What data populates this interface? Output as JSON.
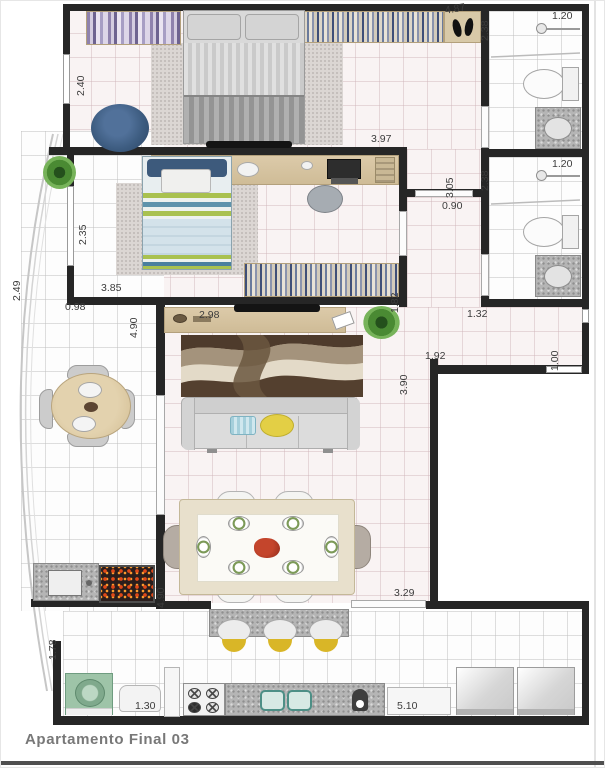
{
  "title": "Apartamento Final 03",
  "dims": {
    "bedroom1_height": "2.40",
    "bedroom1_width": "4.87",
    "bath1_height": "2.38",
    "bath1_width": "1.20",
    "bedroom1_bottom": "3.97",
    "hall_height": "3.05",
    "hall_door": "0.90",
    "bath2_height": "2.38",
    "bath2_width": "1.20",
    "bedroom2_height": "2.35",
    "bedroom2_width": "3.85",
    "terrace_height": "2.49",
    "terrace_width": "0.98",
    "living_top_width": "4.90",
    "sideboard_width": "2.98",
    "corridor_height": "1.82",
    "bath2_bottom": "1.32",
    "entry_width": "1.92",
    "entry_height": "1.00",
    "living_right_height": "3.90",
    "living_bottom": "3.29",
    "dining_height": "4.90",
    "gourmet_height": "1.78",
    "laundry_width": "1.30",
    "kitchen_width": "5.10"
  },
  "colors": {
    "wall": "#262626",
    "floor_tint": "#f9f3f3",
    "wood": "#d6c4a4",
    "granite": "#b5b5b5",
    "pouf_blue": "#3d5c80",
    "bed2_green": "#a9c14f",
    "bed2_teal": "#5e93ab",
    "pillow_yellow": "#e3cf45",
    "pillow_blue": "#a5cfdb",
    "rug_brown": "#4e3b2c",
    "rug_cream": "#e3dac8",
    "washer_green": "#9ec4a8",
    "stool_yellow": "#d9b627",
    "coal_red": "#e04818",
    "dim_text": "#3c3c3c",
    "title_text": "#787878"
  }
}
